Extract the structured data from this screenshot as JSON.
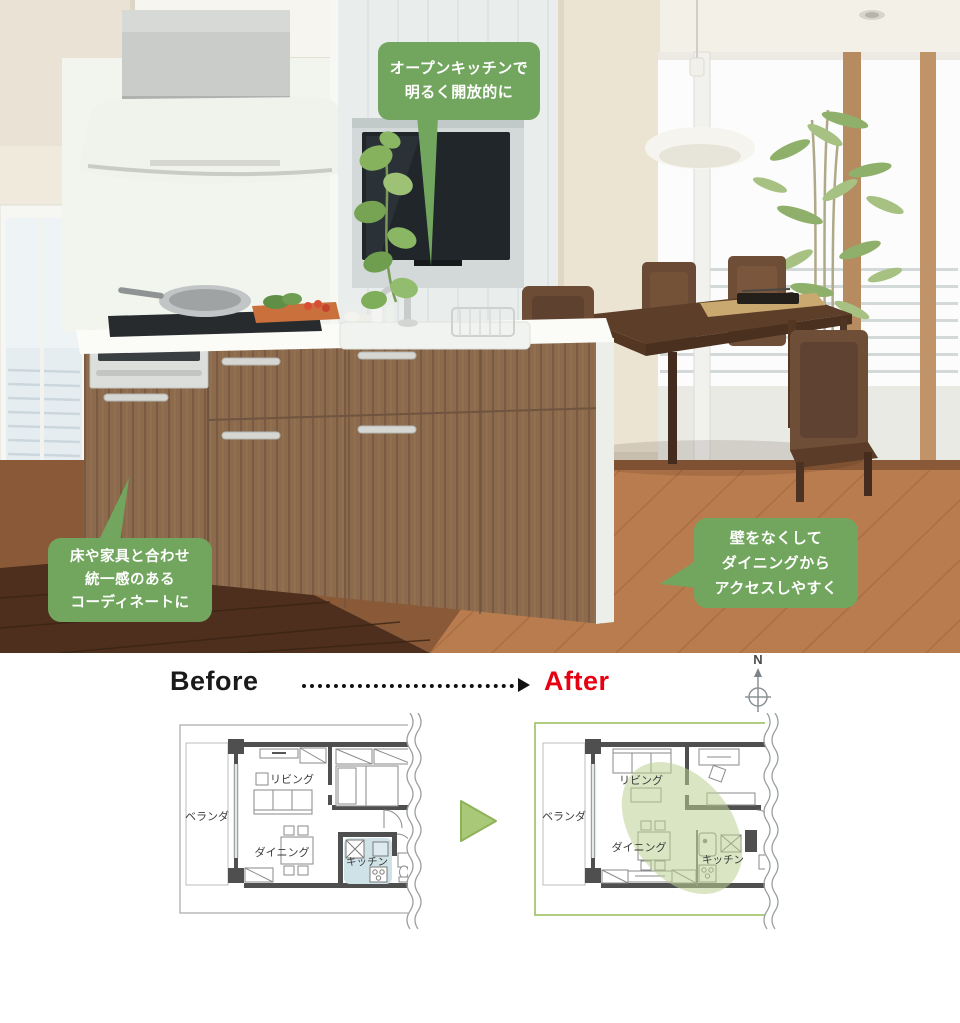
{
  "photo": {
    "description": "open kitchen and dining room photograph",
    "callout_color": "#72a65e",
    "callouts": [
      {
        "id": "open-kitchen",
        "text": "オープンキッチンで\n明るく開放的に"
      },
      {
        "id": "coordinate",
        "text": "床や家具と合わせ\n統一感のある\nコーディネートに"
      },
      {
        "id": "wall-access",
        "text": "壁をなくして\nダイニングから\nアクセスしやすく"
      }
    ]
  },
  "comparison": {
    "before_label": "Before",
    "after_label": "After",
    "after_color": "#e60012",
    "compass_north_label": "N"
  },
  "floorplans": {
    "before": {
      "living": "リビング",
      "dining": "ダイニング",
      "kitchen": "キッチン",
      "veranda": "ベランダ",
      "kitchen_highlight": "#cfe2e8"
    },
    "after": {
      "living": "リビング",
      "dining": "ダイニング",
      "kitchen": "キッチン",
      "veranda": "ベランダ",
      "open_area_highlight": "#c3d69e",
      "border_color": "#9cbf62"
    }
  }
}
